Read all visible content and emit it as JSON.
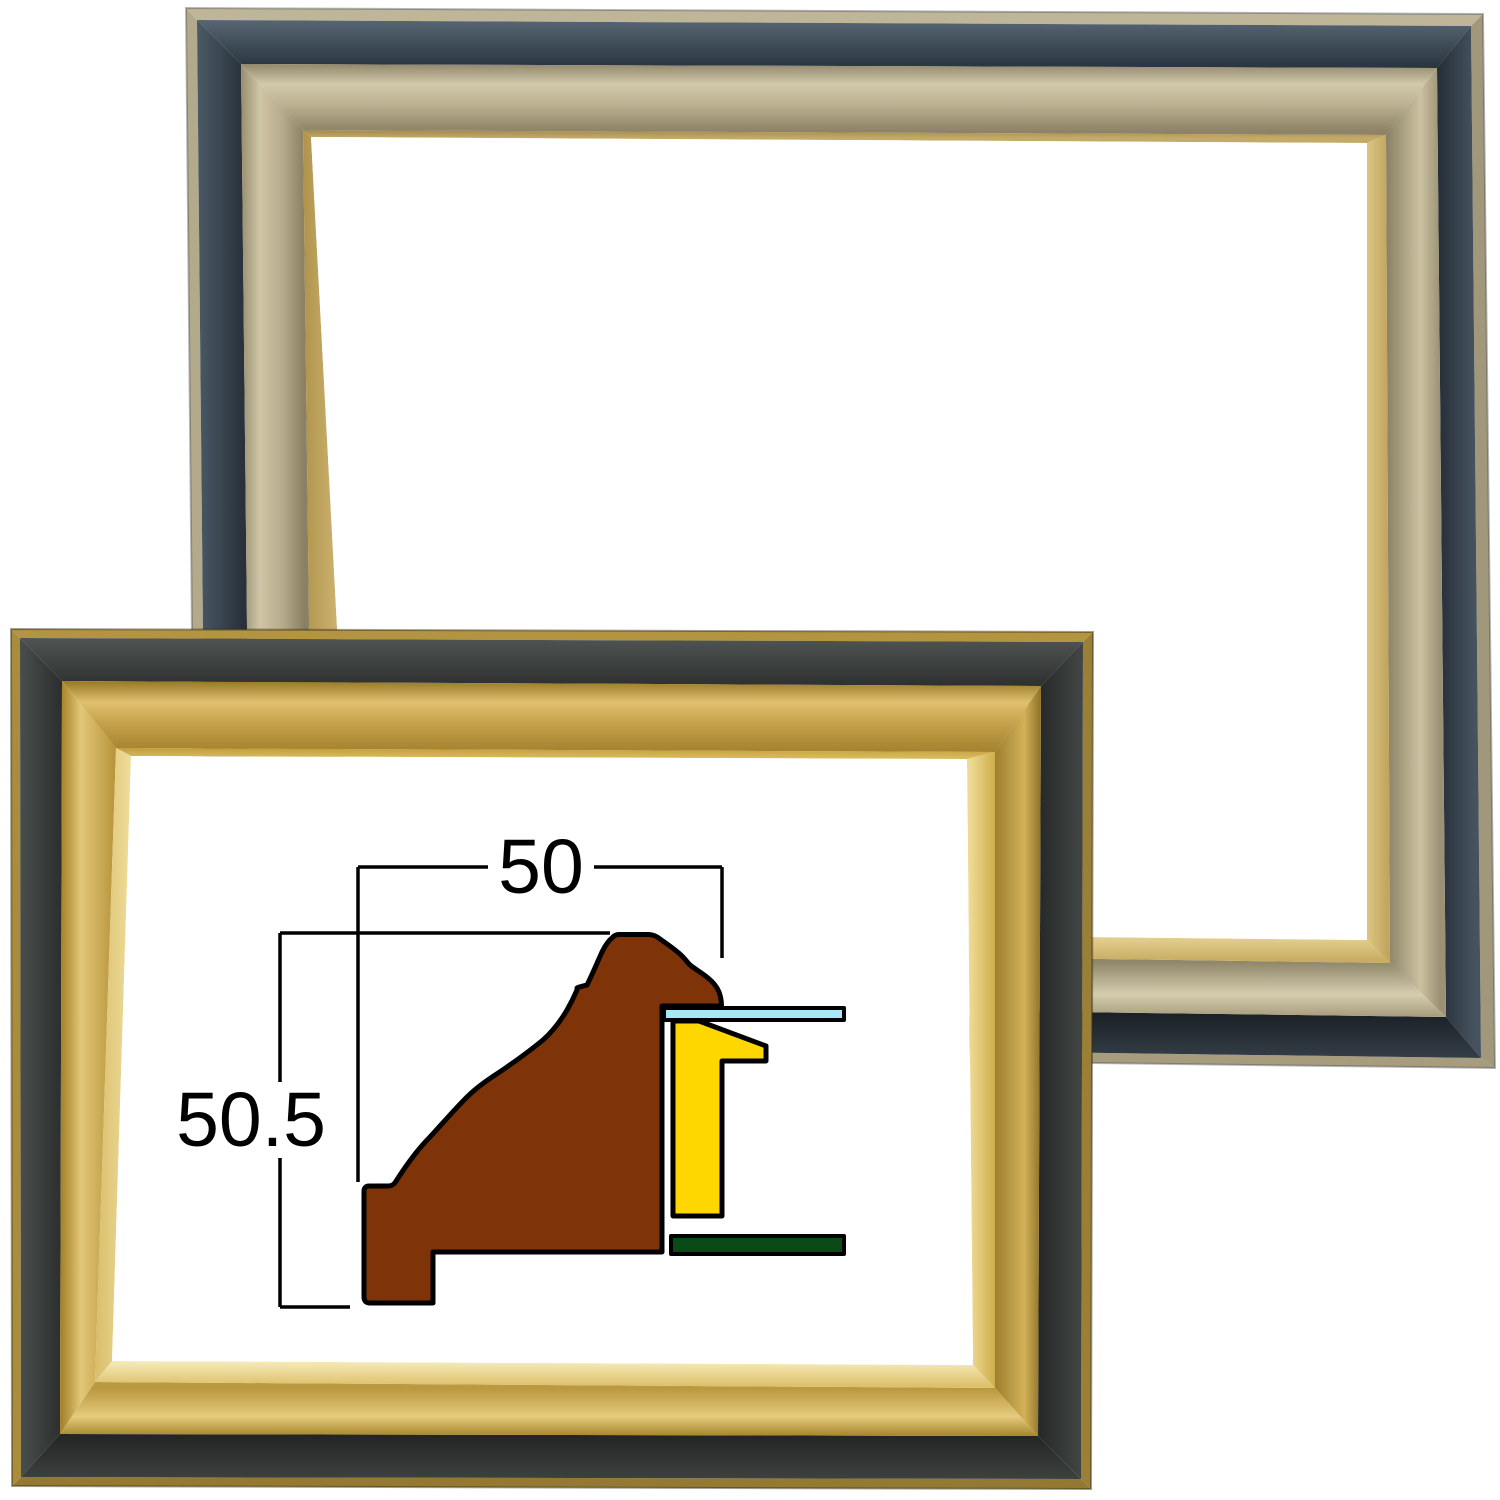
{
  "diagram": {
    "name": "frame-moulding-cross-section",
    "width_label": "50",
    "height_label": "50.5",
    "colors": {
      "moulding_profile": "#7E3408",
      "liner": "#FFD700",
      "glass": "#A9E6F7",
      "backboard": "#0A4A16",
      "outline": "#000000",
      "dimension_lines": "#000000"
    }
  },
  "frames": {
    "back_frame": {
      "name": "silver-blue-gray-frame-back",
      "outer_edge_color": "#B3A98B",
      "dark_band_color": "#36434F",
      "slope_color": "#C6BC9D",
      "inner_lip_color": "#D5BB74",
      "opening_color": "#FFFFFF"
    },
    "front_frame": {
      "name": "gold-black-frame-front",
      "outer_edge_color": "#A8893C",
      "dark_band_color": "#343837",
      "slope_color": "#D3B25B",
      "inner_lip_color": "#EEDC9C",
      "opening_color": "#FFFFFF"
    }
  },
  "background_color": "#FFFFFF"
}
